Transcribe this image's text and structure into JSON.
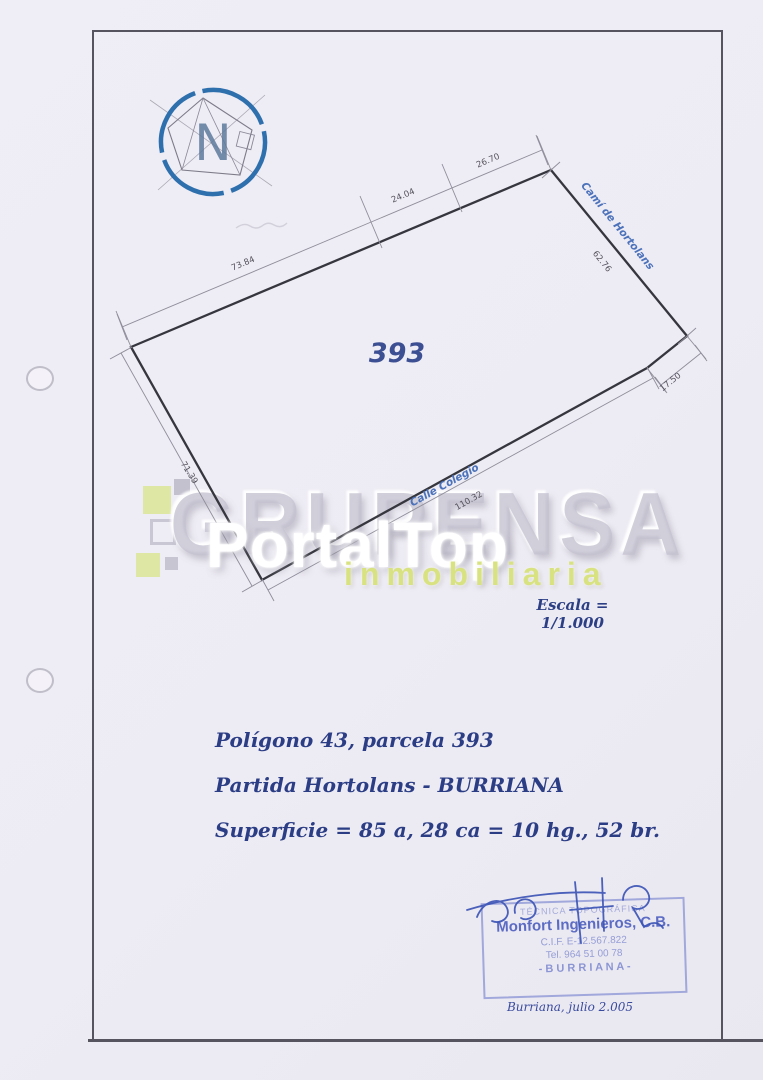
{
  "page": {
    "background": "#edebf3",
    "border_color": "#56545f"
  },
  "compass": {
    "label": "N"
  },
  "plot": {
    "parcel_number": "393",
    "scale_label": "Escala = 1/1.000",
    "streets": {
      "top_right": "Camí de Hortolans",
      "bottom": "Calle Colegio"
    },
    "dimensions": {
      "top_left": "73.84",
      "top_mid": "24.04",
      "top_right": "26.70",
      "right": "62.76",
      "right_short": "17.50",
      "bottom": "110.32",
      "left": "71.39"
    }
  },
  "watermark": {
    "company": "GRUPENSA",
    "overlay": "PortalTop",
    "tagline": "inmobiliaria",
    "accent_green": "#d9e281",
    "gray": "#c4c2cf"
  },
  "details": {
    "line1": "Polígono 43, parcela 393",
    "line2": "Partida Hortolans - BURRIANA",
    "line3": "Superficie = 85 a, 28 ca = 10 hg., 52 br."
  },
  "stamp": {
    "line1": "TÉCNICA TOPOGRÁFICA",
    "line2": "Monfort Ingenieros, C.B.",
    "line3": "C.I.F. E-12.567.822",
    "line4": "Tel. 964 51 00 78",
    "line5": "- B U R R I A N A -",
    "color": "#4d5fc0"
  },
  "footer": {
    "date_note": "Burriana, julio 2.005"
  }
}
